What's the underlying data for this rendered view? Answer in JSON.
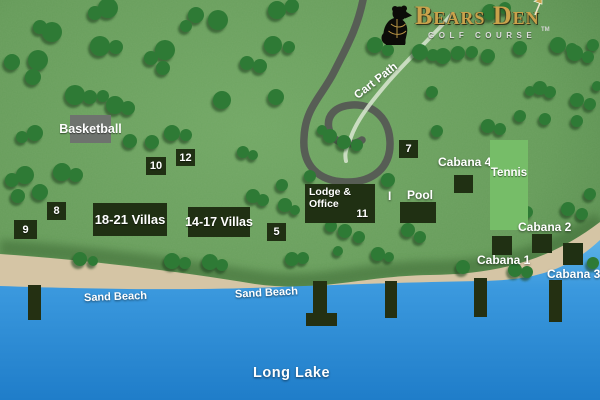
{
  "logo": {
    "title": "Bears Den",
    "subtitle": "GOLF COURSE",
    "trademark": "TM"
  },
  "map": {
    "cart_path_label": "Cart Path",
    "marker_label": "I",
    "facilities": {
      "basketball": "Basketball",
      "tennis": "Tennis",
      "pool": "Pool",
      "lodge_line1": "Lodge &",
      "lodge_line2": "Office"
    },
    "villas": {
      "villas_18_21": "18-21 Villas",
      "villas_14_17": "14-17 Villas"
    },
    "sites": {
      "site5": "5",
      "site7": "7",
      "site8": "8",
      "site9": "9",
      "site10": "10",
      "site11": "11",
      "site12": "12"
    },
    "cabanas": {
      "cabana1": "Cabana 1",
      "cabana2": "Cabana 2",
      "cabana3": "Cabana 3",
      "cabana4": "Cabana 4"
    },
    "beach": {
      "left_label": "Sand Beach",
      "right_label": "Sand Beach"
    },
    "lake_label": "Long Lake"
  },
  "colors": {
    "grass": "#669c5a",
    "grass_dark": "#4a7c42",
    "tree": "#2e7a35",
    "sand": "#d5c5a5",
    "water_top": "#5cb2e8",
    "water_bottom": "#1f7dc9",
    "road": "#575d55",
    "cart_path": "#d9e6d1",
    "building_box": "#203013",
    "basketball_box": "#6e736e",
    "tennis_court": "#76bd68",
    "dock": "#243012",
    "logo_gold": "#c9a24b"
  }
}
